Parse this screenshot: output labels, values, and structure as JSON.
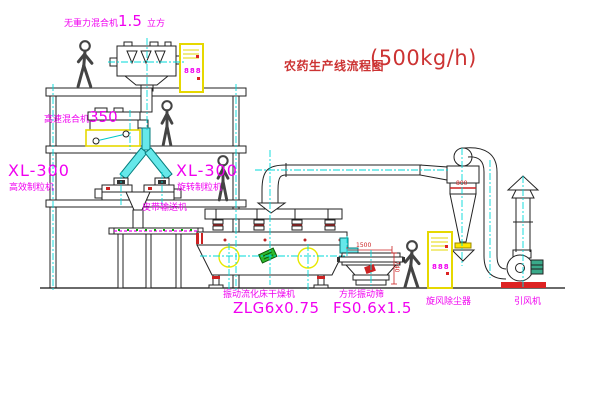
{
  "title": {
    "text": "农药生产线流程图",
    "capacity": "(500kg/h)"
  },
  "equipment_labels": {
    "gravity_mixer": {
      "name": "无重力混合机",
      "size": "1.5",
      "unit": "立方"
    },
    "high_speed_mixer": {
      "name": "高速混合机",
      "size": "350"
    },
    "granulator_left": {
      "model": "XL-300",
      "name": "高效制粒机"
    },
    "granulator_mid": {
      "model": "XL-300",
      "name": "旋转制粒机"
    },
    "belt_conveyor": {
      "name": "皮带输送机"
    },
    "fluid_bed_dryer": {
      "name": "振动流化床干燥机",
      "model": "ZLG6x0.75"
    },
    "vibrating_sieve": {
      "name": "方形振动筛",
      "model": "FS0.6x1.5"
    },
    "cyclone": {
      "name": "旋风除尘器"
    },
    "fan": {
      "name": "引风机"
    }
  },
  "dimensions": {
    "sieve_length": "1500",
    "sieve_height": "740",
    "cyclone_band": "800"
  },
  "control_cabinet": {
    "display": "888"
  },
  "colors": {
    "label": "#f000f0",
    "title": "#cc3333",
    "centerline": "#00d9d9",
    "cabinet": "#e6d800",
    "dimension": "#cc2222"
  }
}
